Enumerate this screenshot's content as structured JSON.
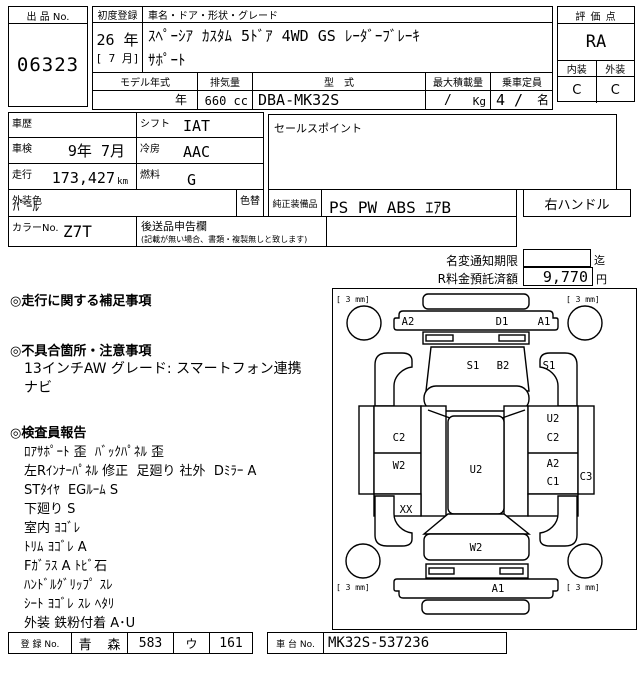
{
  "header": {
    "lot_label": "出 品 No.",
    "lot_number": "06323",
    "first_registration": {
      "label": "初度登録",
      "year": "26 年",
      "month": "[ 7 月]"
    },
    "car_name": {
      "label": "車名・ドア・形状・グレード",
      "line1": "ｽﾍﾟｰｼｱ ｶｽﾀﾑ 5ﾄﾞｱ 4WD GS ﾚｰﾀﾞｰﾌﾞﾚｰｷ",
      "line2": "ｻﾎﾟｰﾄ"
    },
    "score": {
      "label": "評 価 点",
      "value": "RA"
    },
    "interior": {
      "label": "内装",
      "value": "C"
    },
    "exterior": {
      "label": "外装",
      "value": "C"
    },
    "model_year": {
      "label": "モデル年式",
      "value": "年"
    },
    "displacement": {
      "label": "排気量",
      "value": "660 cc"
    },
    "model_code": {
      "label": "型　式",
      "value": "DBA-MK32S"
    },
    "max_load": {
      "label": "最大積載量",
      "value": "/",
      "unit": "Kg"
    },
    "capacity": {
      "label": "乗車定員",
      "value": "4 /",
      "unit": "名"
    }
  },
  "details": {
    "history": {
      "label": "車歴",
      "value": ""
    },
    "shift": {
      "label": "シフト",
      "value": "IAT"
    },
    "inspection": {
      "label": "車検",
      "value": "9年 7月"
    },
    "ac": {
      "label": "冷房",
      "value": "AAC"
    },
    "mileage": {
      "label": "走行",
      "value": "173,427",
      "unit": "km"
    },
    "fuel": {
      "label": "燃料",
      "value": "G"
    },
    "exterior_color": {
      "label": "外装色",
      "value": "ﾊﾟｰﾙ"
    },
    "color_change": {
      "label": "色替"
    },
    "color_no": {
      "label": "カラーNo.",
      "value": "Z7T"
    },
    "late_items": {
      "label": "後送品申告欄",
      "note": "(記載が無い場合、書類・複製無しと致します)"
    },
    "sales_point": {
      "label": "セールスポイント",
      "value": ""
    },
    "equipment": {
      "label": "純正装備品",
      "value": "PS PW ABS ｴｱB"
    },
    "handle": "右ハンドル"
  },
  "notice": {
    "name_change": {
      "label": "名変通知期限",
      "value": "",
      "suffix": "迄"
    },
    "recycle_fee": {
      "label": "R料金預託済額",
      "value": "9,770",
      "suffix": "円"
    }
  },
  "sections": {
    "mileage_notes": {
      "title": "◎走行に関する補足事項"
    },
    "defect_notes": {
      "title": "◎不具合箇所・注意事項",
      "lines": [
        "13インチAW グレード: スマートフォン連携",
        "ナビ"
      ]
    },
    "inspector_report": {
      "title": "◎検査員報告",
      "lines": [
        "ﾛｱｻﾎﾟｰﾄ 歪  ﾊﾞｯｸﾊﾟﾈﾙ 歪",
        "左Rｲﾝﾅｰﾊﾟﾈﾙ 修正  足廻り 社外  Dﾐﾗｰ A",
        "STﾀｲﾔ  EGﾙｰﾑ S",
        "下廻り S",
        "室内 ﾖｺﾞﾚ",
        "ﾄﾘﾑ ﾖｺﾞﾚ A",
        "Fｶﾞﾗｽ A ﾄﾋﾞ石",
        "ﾊﾝﾄﾞﾙｸﾞﾘｯﾌﾟ ｽﾚ",
        "ｼｰﾄ ﾖｺﾞﾚ ｽﾚ ﾍﾀﾘ",
        "外装 鉄粉付着 A･U"
      ]
    }
  },
  "footer": {
    "reg_label": "登 録 No.",
    "reg_area": "青  森",
    "reg_class": "583",
    "reg_kana": "ウ",
    "reg_number": "161",
    "chassis_label": "車 台 No.",
    "chassis_no": "MK32S-537236"
  },
  "diagram": {
    "tire_label": "[ 3 mm]",
    "codes": {
      "front_bumper_left": "A2",
      "front_bumper_center": "D1",
      "front_bumper_right": "A1",
      "hood_left": "S1",
      "hood_right": "B2",
      "right_front_fender": "S1",
      "left_door_top": "C2",
      "left_door_bottom": "W2",
      "roof": "U2",
      "right_door_top_1": "U2",
      "right_door_top_2": "C2",
      "right_door_bottom_1": "A2",
      "right_door_bottom_2": "C1",
      "right_rocker": "C3",
      "left_rear_quarter": "XX",
      "rear_hatch": "W2",
      "rear_bumper": "A1"
    }
  }
}
